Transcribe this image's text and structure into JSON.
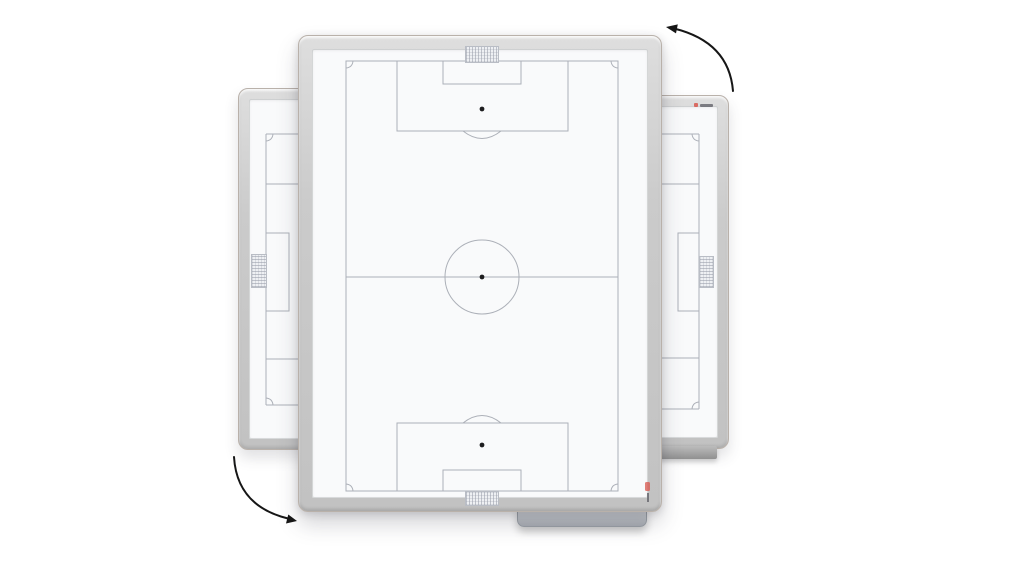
{
  "scene": {
    "type": "product-render",
    "subject": "rotatable soccer tactics whiteboard shown front-on with two 90-degree-rotated copies behind it"
  },
  "colors": {
    "background": "#ffffff",
    "frame": "#c9c9c9",
    "frame_edge": "#b9b1aa",
    "board_face": "#f9fafb",
    "pitch_line": "#acb0b8",
    "spot": "#1d1d1f",
    "net_fill": "#eef0f3",
    "net_line": "#b9bdc5",
    "tray": "#b5b9bf",
    "arrow": "#161616",
    "logo_red": "#d8574d",
    "logo_dark": "#63636a"
  },
  "boards": [
    {
      "id": "main",
      "orientation": "portrait",
      "marking": "full soccer pitch"
    },
    {
      "id": "left",
      "orientation": "landscape",
      "marking": "soccer pitch goal end"
    },
    {
      "id": "right",
      "orientation": "landscape",
      "marking": "soccer pitch goal end"
    }
  ],
  "rotation_arrows": [
    {
      "position": "top-right",
      "direction": "counterclockwise"
    },
    {
      "position": "bottom-left",
      "direction": "counterclockwise"
    }
  ]
}
